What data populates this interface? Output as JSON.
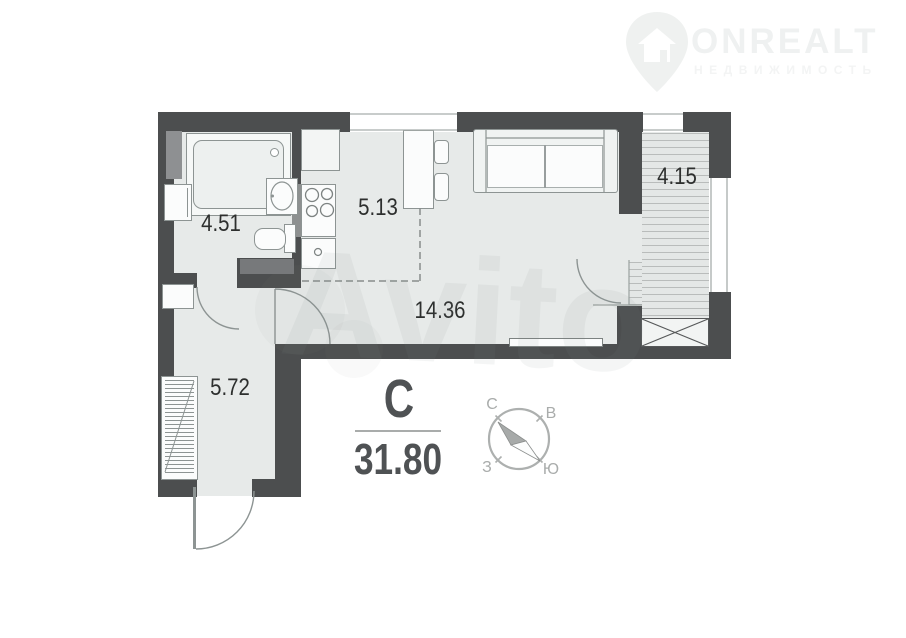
{
  "logo": {
    "brand": "ONREALT",
    "tagline": "НЕДВИЖИМОСТЬ"
  },
  "watermark": {
    "text": "Avito"
  },
  "plan": {
    "total_area_label": "31.80",
    "north_letter": "С",
    "rooms": [
      {
        "name": "bathroom",
        "area_label": "4.51"
      },
      {
        "name": "kitchen",
        "area_label": "5.13"
      },
      {
        "name": "living-room",
        "area_label": "14.36"
      },
      {
        "name": "balcony",
        "area_label": "4.15"
      },
      {
        "name": "hallway",
        "area_label": "5.72"
      }
    ],
    "compass": {
      "north": "С",
      "east": "В",
      "west": "З",
      "south": "Ю"
    },
    "colors": {
      "wall": "#4c4e4f",
      "floor": "#e7eae9",
      "accent_text": "#4f5254"
    }
  }
}
